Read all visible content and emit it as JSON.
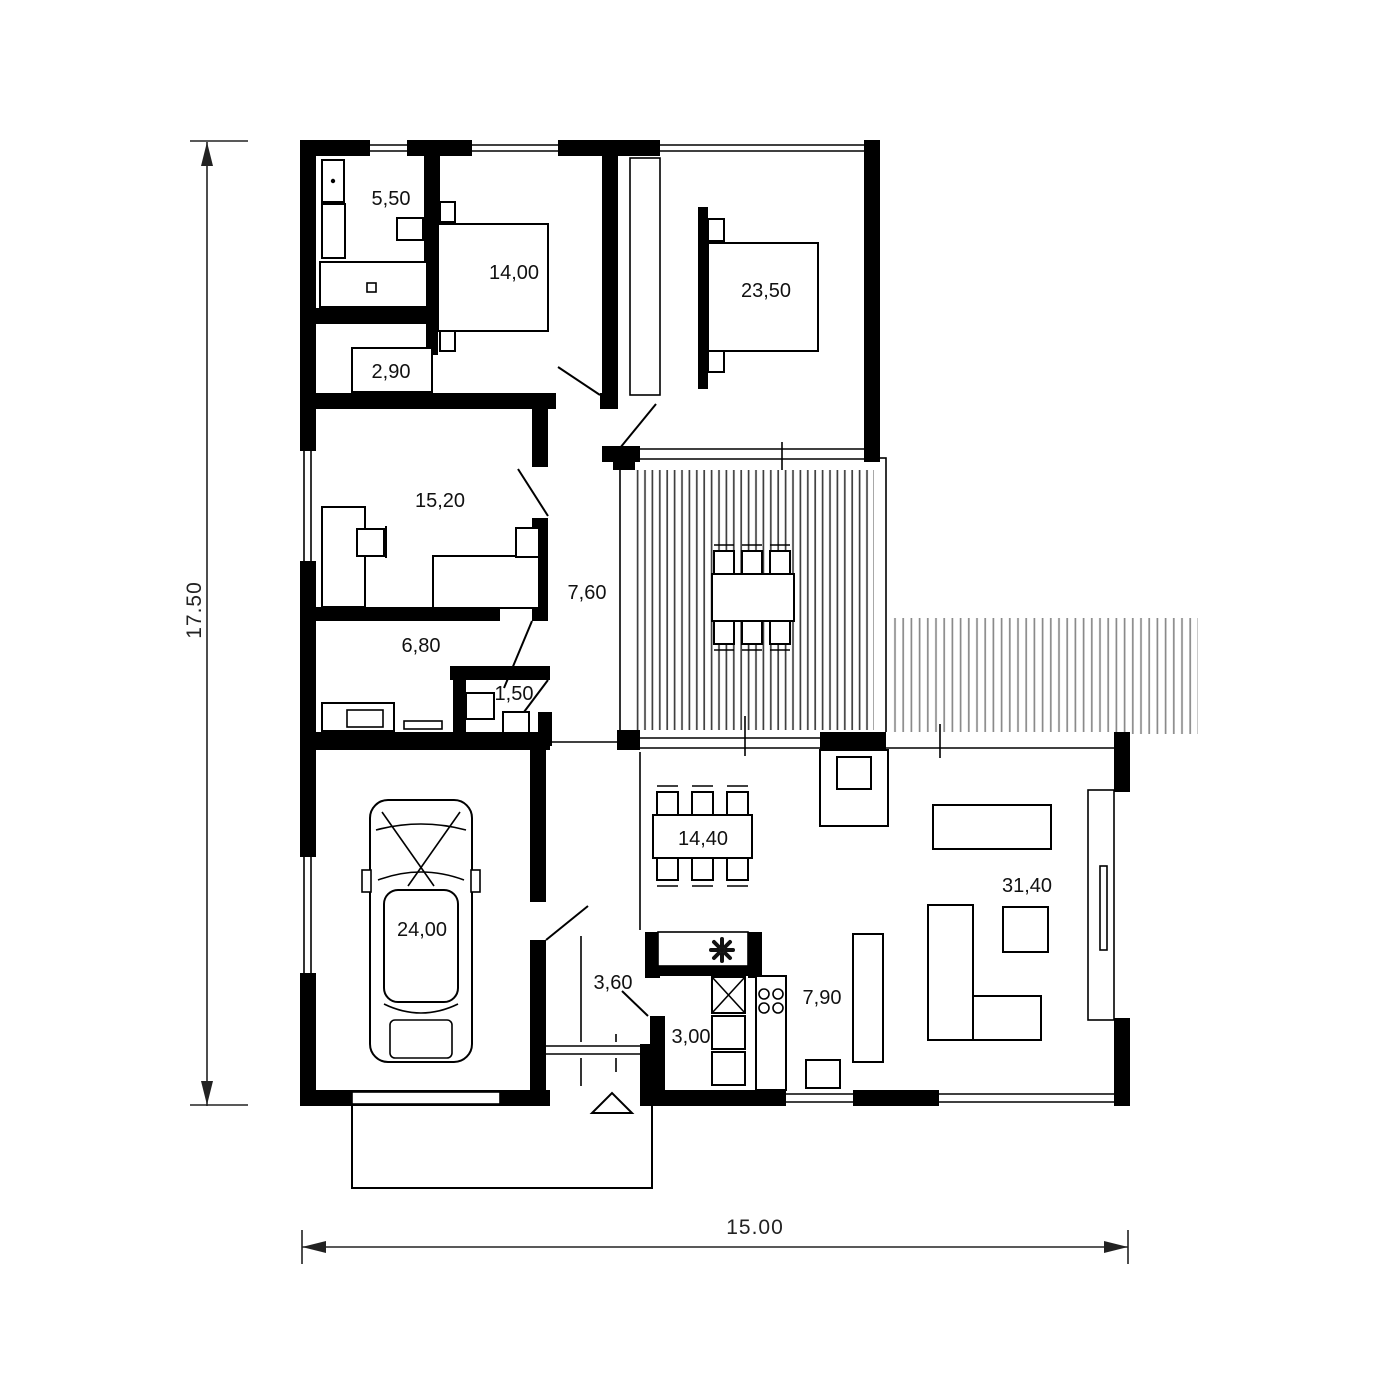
{
  "plan": {
    "rooms": [
      {
        "name": "bathroom",
        "area": "5,50"
      },
      {
        "name": "bedroom",
        "area": "14,00"
      },
      {
        "name": "master-bedroom",
        "area": "23,50"
      },
      {
        "name": "wardrobe",
        "area": "2,90"
      },
      {
        "name": "study",
        "area": "15,20"
      },
      {
        "name": "hallway",
        "area": "7,60"
      },
      {
        "name": "hall",
        "area": "6,80"
      },
      {
        "name": "wc",
        "area": "1,50"
      },
      {
        "name": "garage",
        "area": "24,00"
      },
      {
        "name": "dining",
        "area": "14,40"
      },
      {
        "name": "living-room",
        "area": "31,40"
      },
      {
        "name": "entry",
        "area": "3,60"
      },
      {
        "name": "pantry",
        "area": "3,00"
      },
      {
        "name": "kitchen",
        "area": "7,90"
      }
    ],
    "dims": {
      "depth": "17.50",
      "width": "15.00"
    },
    "icons": {
      "sink": "flower-asterisk",
      "entrance_marker": "triangle-up",
      "car": "car-top-view"
    },
    "colors": {
      "walls": "#000000",
      "background": "#ffffff",
      "deck_hatch": "#3f3f3f",
      "deck_hatch_light": "#8a8a8a"
    }
  }
}
